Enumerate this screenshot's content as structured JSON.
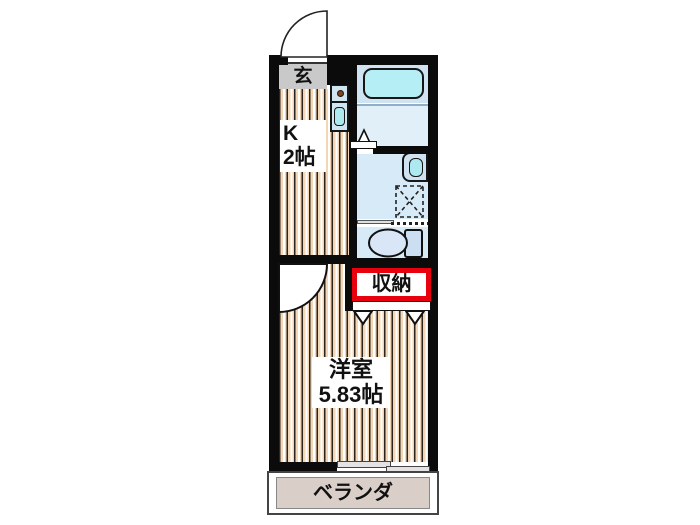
{
  "plan": {
    "type": "apartment-floor-plan",
    "rooms": {
      "entrance": {
        "label": "玄"
      },
      "kitchen": {
        "label": "K",
        "size": "2帖"
      },
      "western_room": {
        "label": "洋室",
        "size": "5.83帖"
      },
      "storage": {
        "label": "収納"
      },
      "balcony": {
        "label": "ベランダ"
      }
    },
    "colors": {
      "wall": "#0b0b0b",
      "flooring": "#f3d6b6",
      "entrance_floor": "#c9c9c9",
      "bath_blue": "#d7eaf7",
      "bath_upper_blue": "#cfe3f2",
      "fixture_cyan": "#aee9f0",
      "storage_accent": "#e8000d",
      "balcony_floor": "#d9cec8"
    }
  }
}
